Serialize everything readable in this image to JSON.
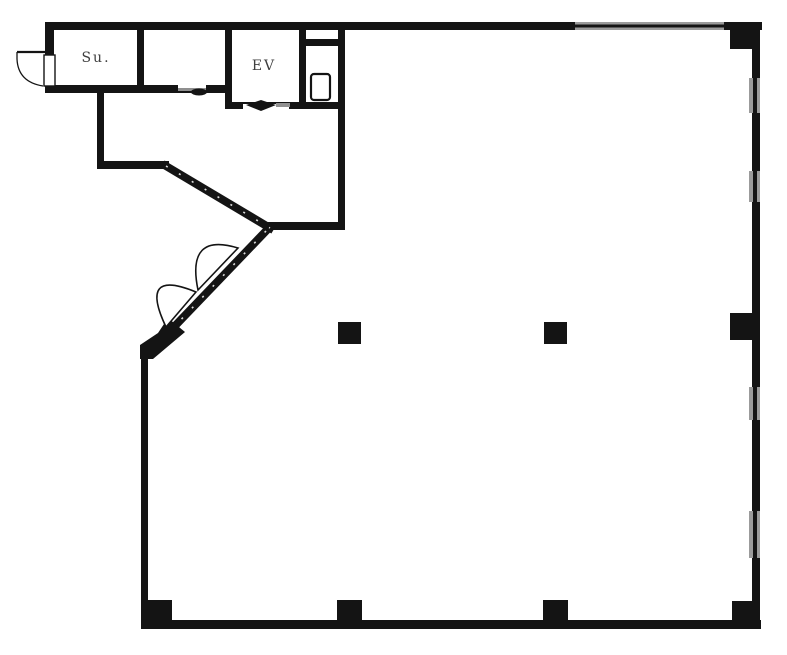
{
  "page": {
    "background": "#ffffff",
    "description": "Scanned monochrome architectural floor plan"
  },
  "labels": {
    "stair_room": "Su.",
    "elevator": "EV"
  },
  "rooms": [
    {
      "name": "stair-room",
      "label": "Su."
    },
    {
      "name": "middle-service-room",
      "label": ""
    },
    {
      "name": "elevator-shaft",
      "label": "EV"
    },
    {
      "name": "wc-room",
      "label": ""
    },
    {
      "name": "entry-hall",
      "label": ""
    },
    {
      "name": "main-open-space",
      "label": ""
    }
  ],
  "colors": {
    "wall": "#141414",
    "window": "#9b9b9b",
    "label_text": "#3e3e3e",
    "background": "#ffffff"
  },
  "features": {
    "columns_count": 8,
    "right_wall_windows": 4,
    "top_wall_windows": 1,
    "entry": "double swing doors on diagonal wall",
    "elevator_door_marker": "diamond",
    "exterior_door": "single swing door at stair room"
  }
}
